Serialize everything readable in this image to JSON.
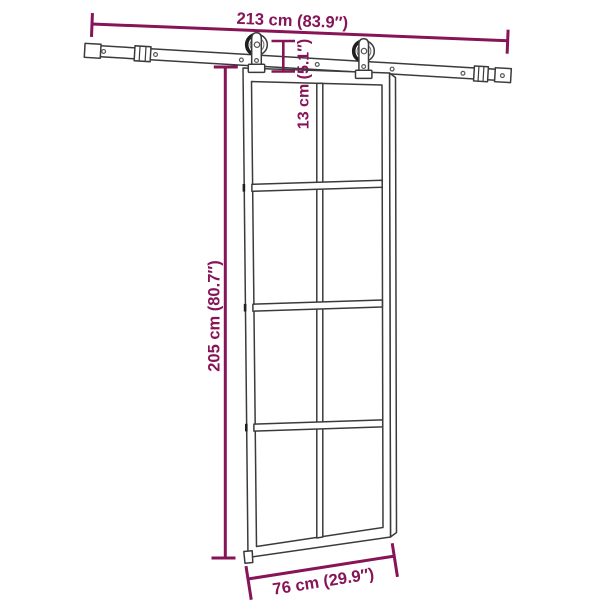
{
  "labels": {
    "rail_width": "213 cm (83.9″)",
    "hanger_height": "13 cm (5.1″)",
    "door_height": "205 cm (80.7″)",
    "door_width": "76 cm (29.9″)"
  },
  "colors": {
    "dimension": "#871457",
    "line_art": "#3B3B3B",
    "line_dark": "#1F1F1F",
    "background": "#FFFFFF"
  }
}
